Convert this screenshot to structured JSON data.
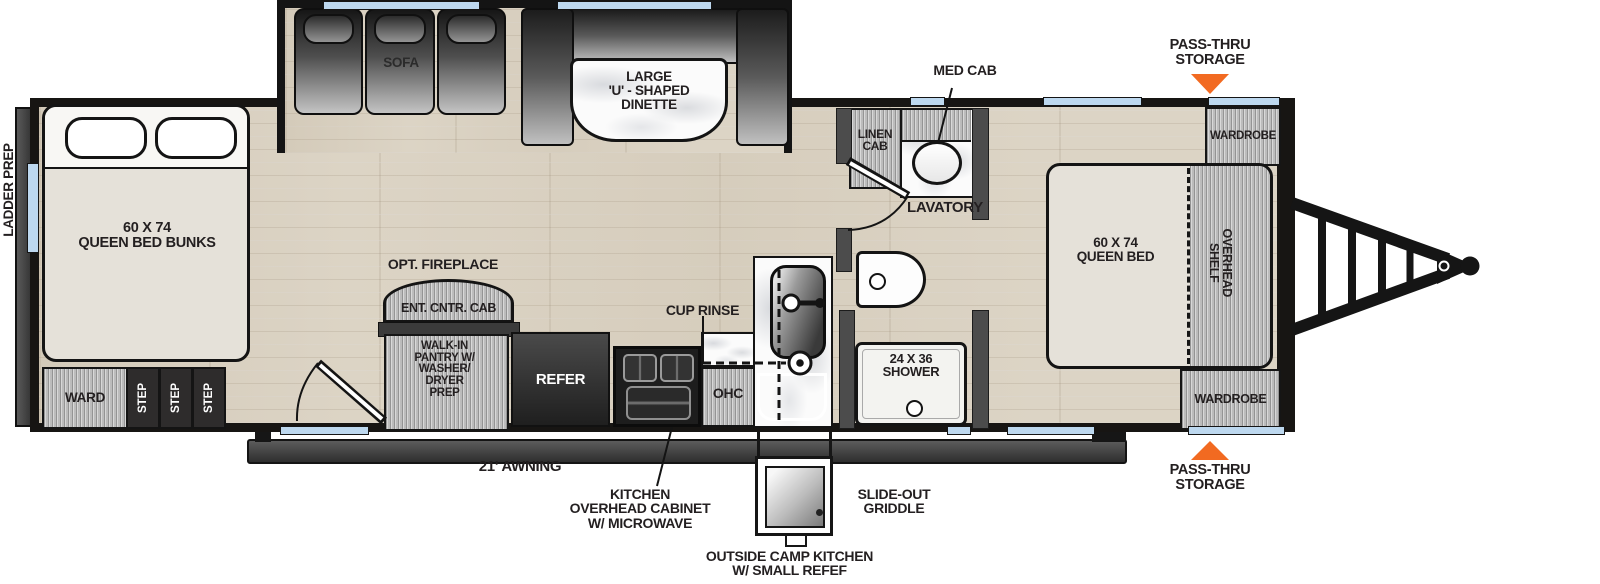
{
  "diagram": {
    "type": "travel-trailer-floorplan",
    "colors": {
      "accent_orange": "#F26A21",
      "window_blue": "#BDD8EF",
      "wall_black": "#171717",
      "floor_wood": "#DCD4C5"
    },
    "rear": {
      "ladder_prep": "LADDER PREP"
    },
    "bunk_room": {
      "bed_lines": [
        "60 X 74",
        "QUEEN BED BUNKS"
      ],
      "ward": "WARD",
      "steps": [
        "STEP",
        "STEP",
        "STEP"
      ]
    },
    "living": {
      "sofa": "SOFA",
      "dinette_lines": [
        "LARGE",
        "'U' - SHAPED",
        "DINETTE"
      ],
      "opt_fireplace": "OPT. FIREPLACE",
      "ent_cntr_cab": "ENT. CNTR. CAB"
    },
    "kitchen": {
      "pantry_lines": [
        "WALK-IN",
        "PANTRY W/",
        "WASHER/",
        "DRYER",
        "PREP"
      ],
      "refer": "REFER",
      "ohc": "OHC",
      "cup_rinse": "CUP RINSE",
      "overhead_cabinet_lines": [
        "KITCHEN",
        "OVERHEAD CABINET",
        "W/ MICROWAVE"
      ],
      "slide_out_griddle_lines": [
        "SLIDE-OUT",
        "GRIDDLE"
      ],
      "outside_camp_kitchen_lines": [
        "OUTSIDE CAMP KITCHEN",
        "W/ SMALL REFEF"
      ]
    },
    "bathroom": {
      "linen_cab_lines": [
        "LINEN",
        "CAB"
      ],
      "med_cab": "MED CAB",
      "lavatory": "LAVATORY",
      "shower_lines": [
        "24 X 36",
        "SHOWER"
      ]
    },
    "bedroom": {
      "queen_bed_lines": [
        "60 X 74",
        "QUEEN BED"
      ],
      "overhead_shelf_lines": [
        "OVERHEAD",
        "SHELF"
      ],
      "wardrobe_front": "WARDROBE",
      "wardrobe_rear": "WARDROBE"
    },
    "exterior": {
      "awning": "21' AWNING",
      "pass_thru_top_lines": [
        "PASS-THRU",
        "STORAGE"
      ],
      "pass_thru_bottom_lines": [
        "PASS-THRU",
        "STORAGE"
      ]
    }
  }
}
